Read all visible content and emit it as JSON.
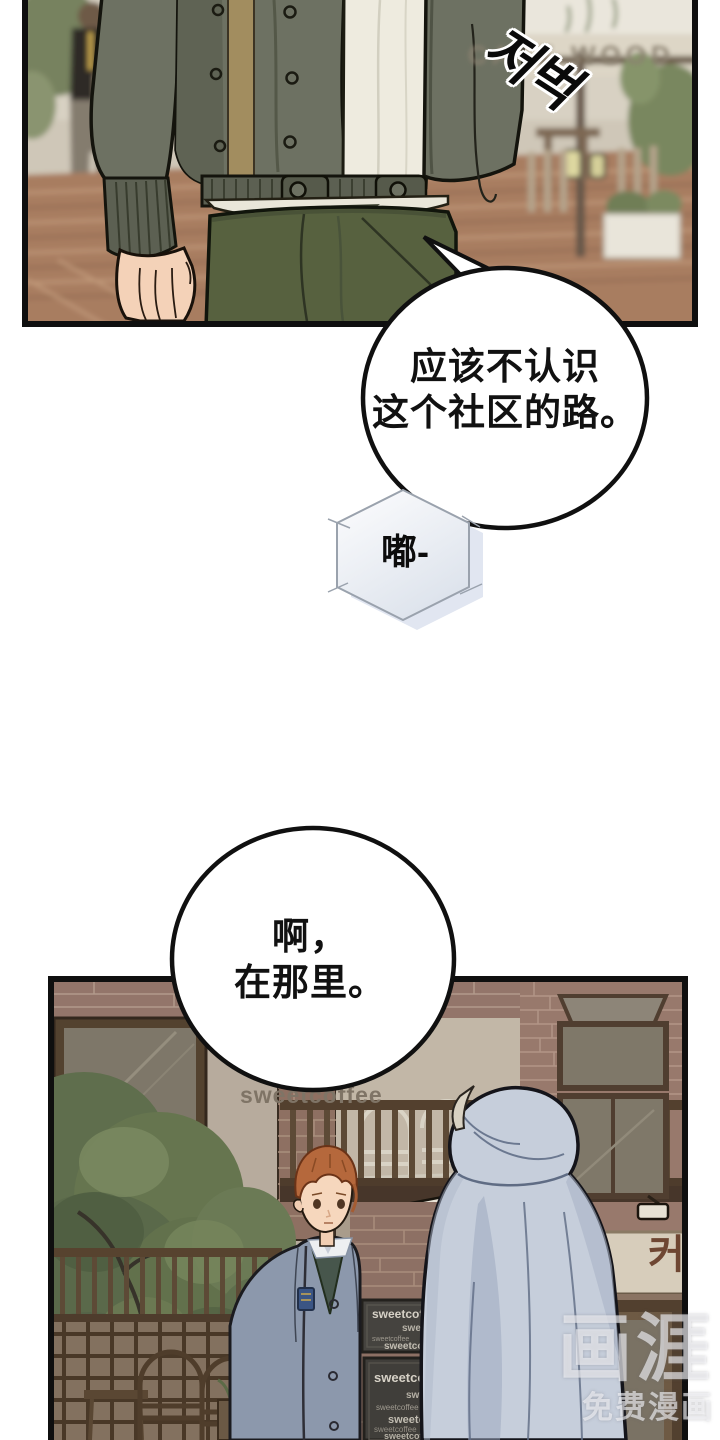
{
  "page": {
    "kind": "webtoon comic page",
    "background": "#ffffff"
  },
  "top_panel": {
    "sfx_korean": "저벅",
    "cafe_sign": "CAFE WOOD"
  },
  "bubbles": {
    "speech1_line1": "应该不认识",
    "speech1_line2": "这个社区的路。",
    "hex_sfx": "嘟-",
    "speech2_line1": "啊，",
    "speech2_line2": "在那里。"
  },
  "bottom_panel": {
    "wall_sign": "sweetcoffee",
    "korean_letter": "커",
    "menu_top": [
      "sweetcoffee",
      "sweetcoffee",
      "sweetcoffee",
      "sweetcoffee"
    ],
    "menu_bottom": [
      "sweetcoffee",
      "sweetcoffee",
      "sweetcoffee",
      "sweetcoffee",
      "sweetcoffee",
      "sweetcoffee"
    ]
  },
  "watermark": {
    "logo": "画涯",
    "tagline": "免费漫画"
  },
  "colors": {
    "panel_border": "#0f0f0f",
    "bubble_border": "#101010",
    "hex_border": "#9aa2ad",
    "cardigan": "#6d7162",
    "cardigan_trim": "#a28d5f",
    "shirt": "#eeebdf",
    "trousers": "#57613f",
    "skin": "#f4d2b8",
    "blazer": "#8c98ac",
    "vest": "#47564c",
    "hair_orange": "#b5683c",
    "hoodie": "#c6cedb",
    "brick": "#97796c",
    "plaster": "#b7ab9d",
    "tree_green": "#66754f",
    "menu_board": "#45433f",
    "sign_text": "#7f7466",
    "korean_sign": "#6e4632",
    "watermark": "rgba(247,247,250,0.62)"
  }
}
